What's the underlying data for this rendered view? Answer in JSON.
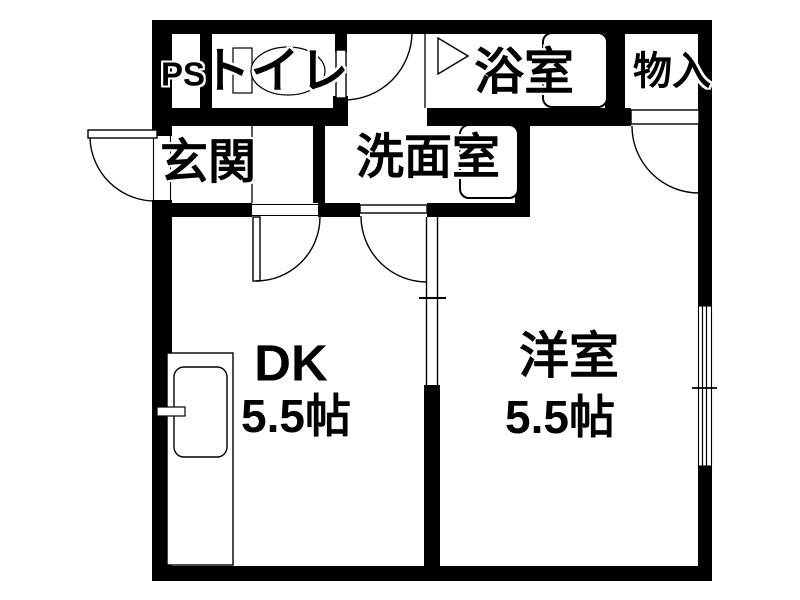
{
  "plan": {
    "title": "apartment-floorplan",
    "colors": {
      "line": "#000000",
      "background": "#ffffff"
    },
    "rooms": {
      "ps": {
        "label": "PS"
      },
      "toilet": {
        "label": "トイレ"
      },
      "bath": {
        "label": "浴室"
      },
      "storage": {
        "label": "物入"
      },
      "entrance": {
        "label": "玄関"
      },
      "washroom": {
        "label": "洗面室"
      },
      "dk": {
        "label": "DK",
        "size": "5.5帖"
      },
      "western_room": {
        "label": "洋室",
        "size": "5.5帖"
      }
    }
  }
}
